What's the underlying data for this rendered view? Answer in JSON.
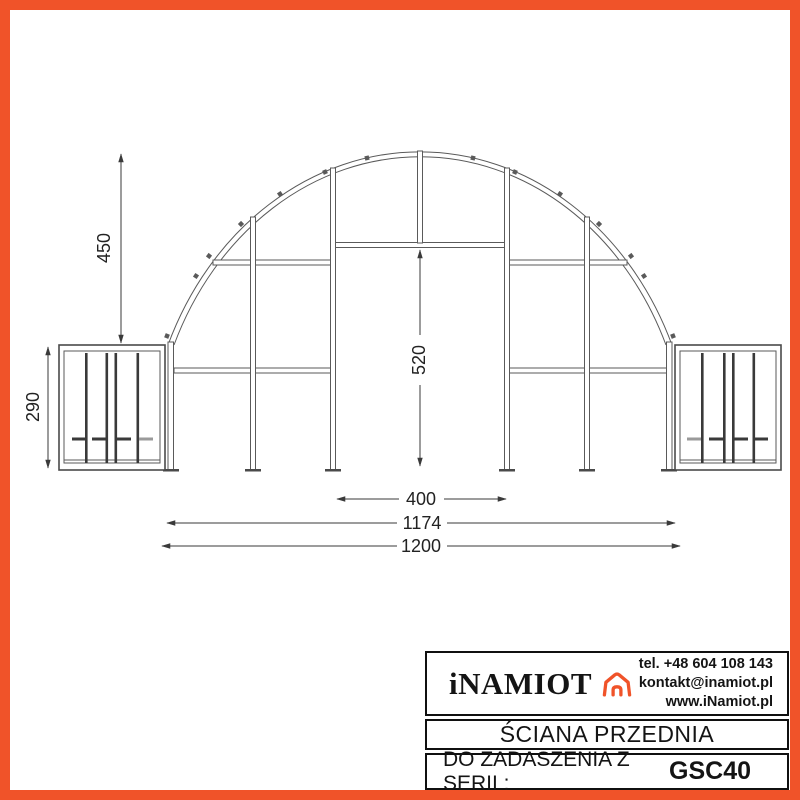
{
  "frame": {
    "border_color": "#F05329"
  },
  "drawing": {
    "dim_arch_height": "450",
    "dim_side_box_height": "290",
    "dim_door_height": "520",
    "dim_door_width": "400",
    "dim_inner_span": "1174",
    "dim_total_span": "1200"
  },
  "title_block": {
    "brand": "iNAMIOT",
    "phone": "tel. +48 604 108 143",
    "email": "kontakt@inamiot.pl",
    "website": "www.iNamiot.pl",
    "drawing_title": "ŚCIANA PRZEDNIA",
    "series_label": "DO ZADASZENIA Z SERII :",
    "series_code": "GSC40",
    "accent_color": "#F05329"
  }
}
